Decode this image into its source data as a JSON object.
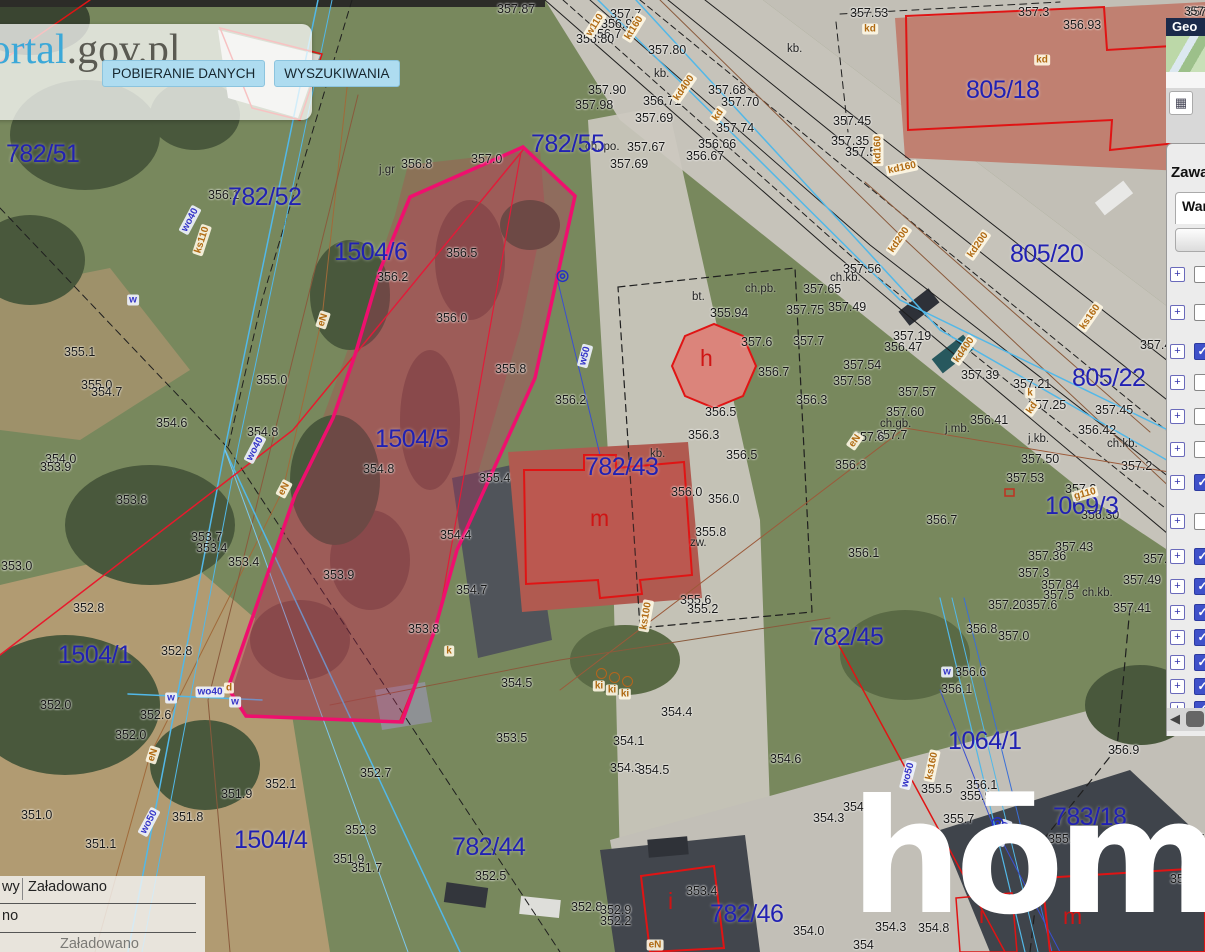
{
  "ui": {
    "logo": {
      "text_blue": "geoportal",
      "text_dark": ".gov.pl"
    },
    "toolbar_buttons": [
      "POBIERANIE DANYCH",
      "WYSZUKIWANIA"
    ],
    "watermark": "hōmfi",
    "sidebar": {
      "map_label": "357",
      "header": "Geo",
      "legend_icon": "▦",
      "panel_title": "Zawa",
      "tab_label": "War",
      "scroll_arrow": "◀",
      "tree": [
        {
          "y": 265,
          "checked": false
        },
        {
          "y": 303,
          "checked": false
        },
        {
          "y": 342,
          "checked": true
        },
        {
          "y": 373,
          "checked": false
        },
        {
          "y": 407,
          "checked": false
        },
        {
          "y": 440,
          "checked": false
        },
        {
          "y": 473,
          "checked": true
        },
        {
          "y": 512,
          "checked": false
        },
        {
          "y": 547,
          "checked": true
        },
        {
          "y": 577,
          "checked": true
        },
        {
          "y": 603,
          "checked": true
        },
        {
          "y": 628,
          "checked": true
        },
        {
          "y": 653,
          "checked": true
        },
        {
          "y": 677,
          "checked": true
        },
        {
          "y": 700,
          "checked": true
        }
      ]
    },
    "status": {
      "row1_left": "wy",
      "row1_right": "Załadowano",
      "row2": "no",
      "row3": "Załadowano"
    }
  },
  "map": {
    "parcels": [
      [
        "782/51",
        6,
        140
      ],
      [
        "782/52",
        228,
        183
      ],
      [
        "1504/6",
        334,
        238
      ],
      [
        "782/55",
        531,
        130
      ],
      [
        "1504/5",
        375,
        425
      ],
      [
        "782/43",
        585,
        453
      ],
      [
        "805/18",
        966,
        76
      ],
      [
        "805/20",
        1010,
        240
      ],
      [
        "805/22",
        1072,
        364
      ],
      [
        "1069/3",
        1045,
        492
      ],
      [
        "782/45",
        810,
        623
      ],
      [
        "1064/1",
        948,
        727
      ],
      [
        "1504/1",
        58,
        641
      ],
      [
        "1504/4",
        234,
        826
      ],
      [
        "782/44",
        452,
        833
      ],
      [
        "782/46",
        710,
        900
      ],
      [
        "783/18",
        1053,
        803
      ]
    ],
    "elevations": [
      [
        "357.87",
        497,
        2
      ],
      [
        "357.7",
        610,
        7
      ],
      [
        "356.9",
        601,
        17
      ],
      [
        "356.7",
        590,
        27
      ],
      [
        "356.80",
        576,
        32
      ],
      [
        "357.80",
        648,
        43
      ],
      [
        "357.90",
        588,
        83
      ],
      [
        "357.98",
        575,
        98
      ],
      [
        "356.71",
        643,
        94
      ],
      [
        "357.69",
        635,
        111
      ],
      [
        "357.68",
        708,
        83
      ],
      [
        "357.70",
        721,
        95
      ],
      [
        "357.74",
        716,
        121
      ],
      [
        "356.66",
        698,
        137
      ],
      [
        "356.67",
        686,
        149
      ],
      [
        "357.67",
        627,
        140
      ],
      [
        "357.69",
        610,
        157
      ],
      [
        "357.53",
        850,
        6
      ],
      [
        "357.3",
        1018,
        5
      ],
      [
        "356.93",
        1063,
        18
      ],
      [
        "357.45",
        833,
        114
      ],
      [
        "357.35",
        831,
        134
      ],
      [
        "357.5",
        845,
        145
      ],
      [
        "357.56",
        843,
        262
      ],
      [
        "357.49",
        828,
        300
      ],
      [
        "357.19",
        893,
        329
      ],
      [
        "356.47",
        884,
        340
      ],
      [
        "357.54",
        843,
        358
      ],
      [
        "357.58",
        833,
        374
      ],
      [
        "357.57",
        898,
        385
      ],
      [
        "357.39",
        961,
        368
      ],
      [
        "357.21",
        1013,
        377
      ],
      [
        "357.25",
        1028,
        398
      ],
      [
        "357.42",
        1140,
        338
      ],
      [
        "357.45",
        1095,
        403
      ],
      [
        "356.41",
        970,
        413
      ],
      [
        "356.42",
        1078,
        423
      ],
      [
        "357.60",
        886,
        405
      ],
      [
        "357.7",
        876,
        428
      ],
      [
        "357.2",
        1121,
        459
      ],
      [
        "357.50",
        1021,
        452
      ],
      [
        "357.53",
        1006,
        471
      ],
      [
        "357.2",
        1065,
        482
      ],
      [
        "356.30",
        1081,
        508
      ],
      [
        "357.43",
        1055,
        540
      ],
      [
        "357.36",
        1028,
        549
      ],
      [
        "357.37",
        1143,
        552
      ],
      [
        "357.3",
        1018,
        566
      ],
      [
        "357.84",
        1041,
        578
      ],
      [
        "357.5",
        1043,
        588
      ],
      [
        "357.49",
        1123,
        573
      ],
      [
        "357.41",
        1113,
        601
      ],
      [
        "357.20",
        988,
        598
      ],
      [
        "357.6",
        1026,
        598
      ],
      [
        "356.8",
        966,
        622
      ],
      [
        "357.0",
        998,
        629
      ],
      [
        "356.6",
        955,
        665
      ],
      [
        "356.1",
        941,
        682
      ],
      [
        "356.9",
        1108,
        743
      ],
      [
        "356.1",
        966,
        778
      ],
      [
        "355.9",
        960,
        789
      ],
      [
        "355.5",
        921,
        782
      ],
      [
        "355.9",
        1048,
        832
      ],
      [
        "356.7",
        1173,
        832
      ],
      [
        "356.2",
        1170,
        872
      ],
      [
        "354.3",
        875,
        920
      ],
      [
        "354.8",
        918,
        921
      ],
      [
        "354.6",
        843,
        800
      ],
      [
        "354.0",
        793,
        924
      ],
      [
        "354",
        853,
        938
      ],
      [
        "355.7",
        943,
        812
      ],
      [
        "357.65",
        803,
        282
      ],
      [
        "357.75",
        786,
        303
      ],
      [
        "357.7",
        793,
        334
      ],
      [
        "356.3",
        796,
        393
      ],
      [
        "356.3",
        835,
        458
      ],
      [
        "357.6",
        853,
        430
      ],
      [
        "356.7",
        926,
        513
      ],
      [
        "356.1",
        848,
        546
      ],
      [
        "355.94",
        710,
        306
      ],
      [
        "357.6",
        741,
        335
      ],
      [
        "356.7",
        758,
        365
      ],
      [
        "356.5",
        705,
        405
      ],
      [
        "356.3",
        688,
        428
      ],
      [
        "356.5",
        726,
        448
      ],
      [
        "356.0",
        671,
        485
      ],
      [
        "356.0",
        708,
        492
      ],
      [
        "355.8",
        695,
        525
      ],
      [
        "356.2",
        555,
        393
      ],
      [
        "356.8",
        401,
        157
      ],
      [
        "357.0",
        471,
        152
      ],
      [
        "356.5",
        446,
        246
      ],
      [
        "356.2",
        377,
        270
      ],
      [
        "356.0",
        436,
        311
      ],
      [
        "355.8",
        495,
        362
      ],
      [
        "354.8",
        363,
        462
      ],
      [
        "355.4",
        479,
        471
      ],
      [
        "354.4",
        440,
        528
      ],
      [
        "353.9",
        323,
        568
      ],
      [
        "354.7",
        456,
        583
      ],
      [
        "353.8",
        408,
        622
      ],
      [
        "356.1",
        208,
        188
      ],
      [
        "355.1",
        64,
        345
      ],
      [
        "355.0",
        81,
        378
      ],
      [
        "354.7",
        91,
        385
      ],
      [
        "354.6",
        156,
        416
      ],
      [
        "354.0",
        45,
        452
      ],
      [
        "353.9",
        40,
        460
      ],
      [
        "354.8",
        247,
        425
      ],
      [
        "355.0",
        256,
        373
      ],
      [
        "353.8",
        116,
        493
      ],
      [
        "353.7",
        191,
        530
      ],
      [
        "353.4",
        196,
        541
      ],
      [
        "353.4",
        228,
        555
      ],
      [
        "353.0",
        1,
        559
      ],
      [
        "352.8",
        73,
        601
      ],
      [
        "352.8",
        161,
        644
      ],
      [
        "352.0",
        40,
        698
      ],
      [
        "352.6",
        140,
        708
      ],
      [
        "352.0",
        115,
        728
      ],
      [
        "351.0",
        21,
        808
      ],
      [
        "351.1",
        85,
        837
      ],
      [
        "351.8",
        172,
        810
      ],
      [
        "351.9",
        221,
        787
      ],
      [
        "352.1",
        265,
        777
      ],
      [
        "354.5",
        501,
        676
      ],
      [
        "353.5",
        496,
        731
      ],
      [
        "352.7",
        360,
        766
      ],
      [
        "352.3",
        345,
        823
      ],
      [
        "351.9",
        333,
        852
      ],
      [
        "351.7",
        351,
        861
      ],
      [
        "352.5",
        475,
        869
      ],
      [
        "352.8",
        571,
        900
      ],
      [
        "352.9",
        600,
        903
      ],
      [
        "352.2",
        600,
        914
      ],
      [
        "354.1",
        613,
        734
      ],
      [
        "354.3",
        610,
        761
      ],
      [
        "354.5",
        638,
        763
      ],
      [
        "355.6",
        680,
        593
      ],
      [
        "355.2",
        687,
        602
      ],
      [
        "354.4",
        661,
        705
      ],
      [
        "354.6",
        770,
        752
      ],
      [
        "354.3",
        813,
        811
      ],
      [
        "353.4",
        686,
        884
      ],
      [
        "357",
        1186,
        5
      ]
    ],
    "annotations": [
      [
        "kb.",
        787,
        43
      ],
      [
        "kb.",
        654,
        68
      ],
      [
        "ch. po.",
        585,
        141
      ],
      [
        "ch.kb.",
        830,
        272
      ],
      [
        "ch.gb.",
        880,
        418
      ],
      [
        "j.mb.",
        945,
        423
      ],
      [
        "j.kb.",
        1028,
        433
      ],
      [
        "ch.kb.",
        1107,
        438
      ],
      [
        "ch.kb.",
        1082,
        587
      ],
      [
        "bt.",
        692,
        291
      ],
      [
        "ch.pb.",
        745,
        283
      ],
      [
        "kb.",
        650,
        448
      ],
      [
        "zw.",
        690,
        537
      ],
      [
        "j.gr",
        379,
        164
      ]
    ],
    "letters": [
      [
        "h",
        700,
        345
      ],
      [
        "m",
        590,
        505
      ],
      [
        "i",
        668,
        888
      ],
      [
        "i",
        979,
        902
      ],
      [
        "m",
        1063,
        903
      ]
    ],
    "u_orange": [
      [
        "w110",
        595,
        25,
        -58
      ],
      [
        "kt160",
        634,
        28,
        -58
      ],
      [
        "kd400",
        684,
        88,
        -55
      ],
      [
        "kd",
        718,
        115,
        -55
      ],
      [
        "kd",
        870,
        29,
        0
      ],
      [
        "kd",
        1042,
        60,
        0
      ],
      [
        "kd160",
        878,
        150,
        -90
      ],
      [
        "kd160",
        902,
        168,
        -12
      ],
      [
        "kd200",
        899,
        240,
        -55
      ],
      [
        "kd200",
        978,
        245,
        -55
      ],
      [
        "kd400",
        964,
        350,
        -55
      ],
      [
        "ks160",
        1090,
        317,
        -55
      ],
      [
        "kd",
        1032,
        408,
        -55
      ],
      [
        "eN",
        855,
        441,
        -55
      ],
      [
        "eN",
        323,
        320,
        -72
      ],
      [
        "eN",
        284,
        489,
        -62
      ],
      [
        "eN",
        153,
        755,
        -72
      ],
      [
        "eN",
        655,
        945,
        0
      ],
      [
        "ks110",
        202,
        240,
        -72
      ],
      [
        "ks100",
        646,
        616,
        -80
      ],
      [
        "ks160",
        932,
        766,
        -78
      ],
      [
        "g110",
        1085,
        494,
        -15
      ],
      [
        "d",
        229,
        688,
        0
      ],
      [
        "k",
        449,
        651,
        0
      ],
      [
        "k",
        1030,
        393,
        0
      ],
      [
        "ki",
        599,
        686,
        0
      ],
      [
        "ki",
        612,
        690,
        0
      ],
      [
        "ki",
        625,
        694,
        0
      ]
    ],
    "u_blue": [
      [
        "wo40",
        190,
        220,
        -62
      ],
      [
        "wo40",
        255,
        449,
        -62
      ],
      [
        "wo40",
        210,
        692,
        0
      ],
      [
        "wo50",
        149,
        822,
        -62
      ],
      [
        "wo50",
        908,
        775,
        -75
      ],
      [
        "w50",
        585,
        356,
        -75
      ],
      [
        "kd30",
        1003,
        833,
        -70
      ],
      [
        "w",
        133,
        300,
        0
      ],
      [
        "w",
        947,
        672,
        0
      ],
      [
        "w",
        171,
        698,
        0
      ],
      [
        "w",
        235,
        702,
        0
      ]
    ],
    "symbols": [
      [
        556,
        266
      ],
      [
        991,
        813
      ],
      [
        350,
        68
      ]
    ],
    "k_circles": [
      [
        596,
        668
      ],
      [
        609,
        672
      ],
      [
        622,
        676
      ]
    ]
  },
  "colors": {
    "parcel_label": "#2121b3",
    "highlight_outline": "#ef0f6e",
    "cadastral_red": "#e01414",
    "utility_orange": "#b06a12",
    "utility_blue": "#3636c8",
    "water_cyan": "#52b8e8"
  }
}
